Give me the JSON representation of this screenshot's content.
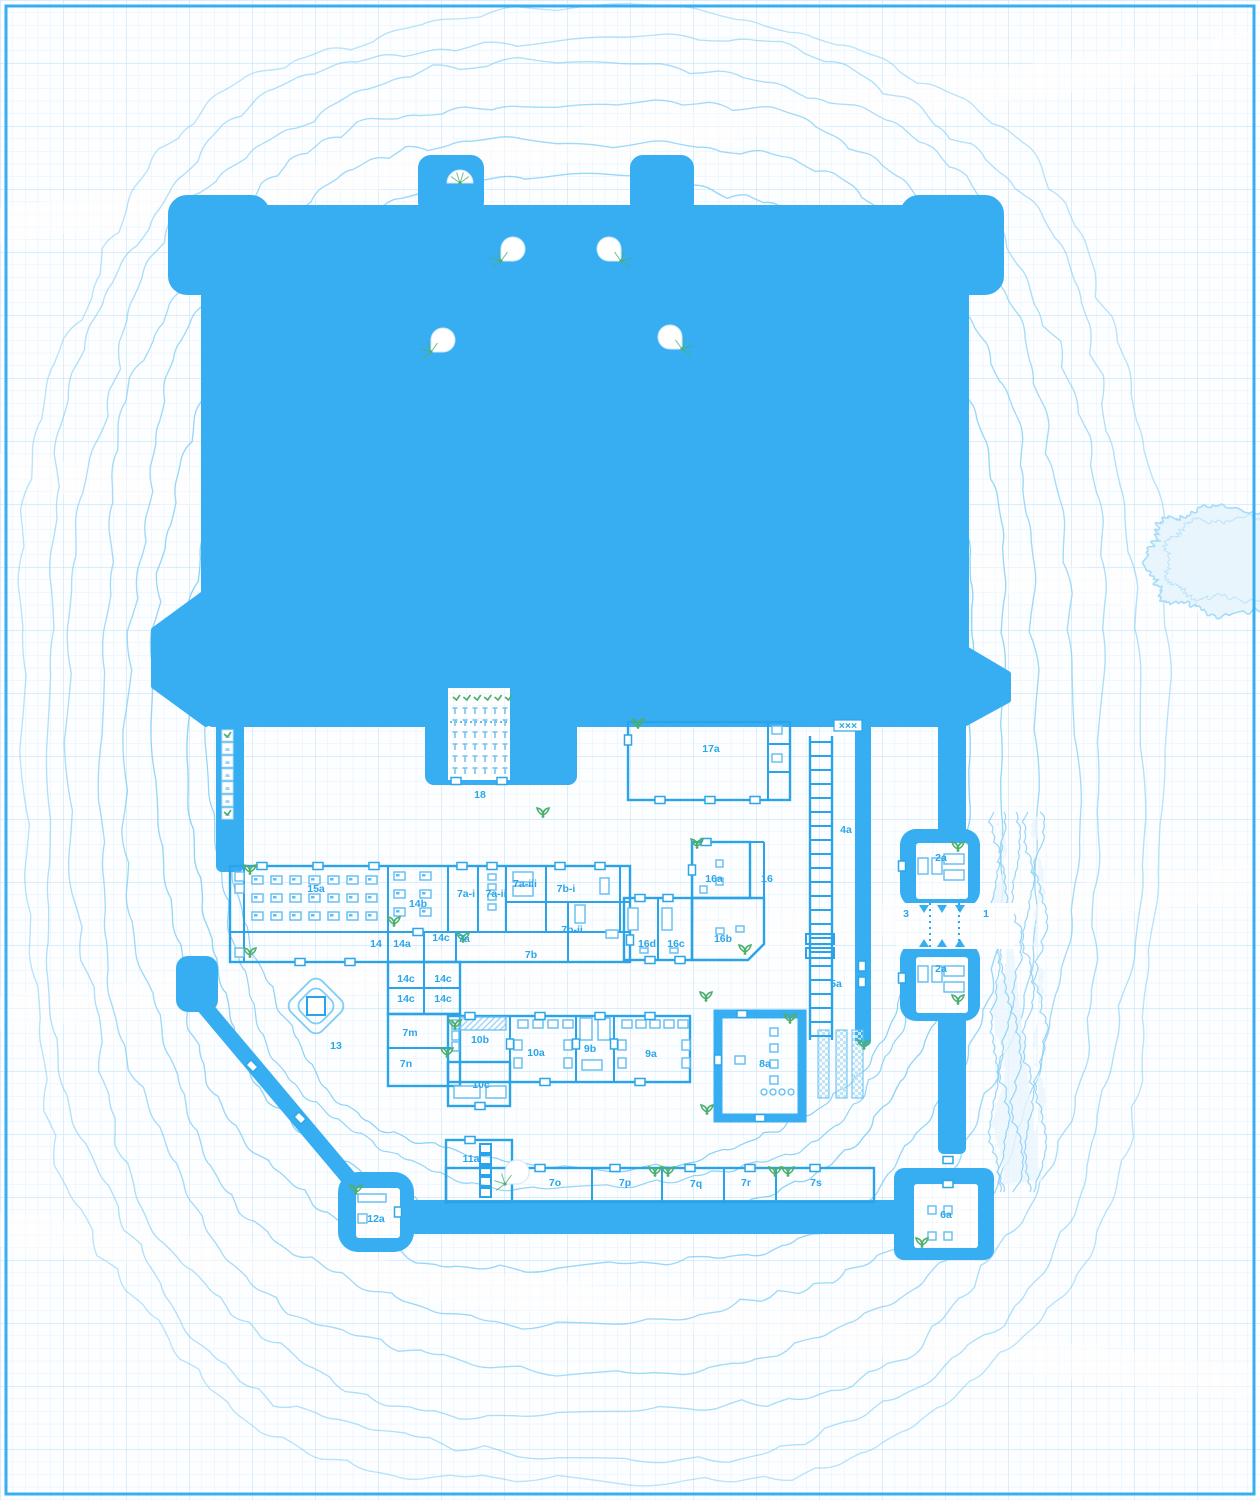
{
  "map": {
    "title": "castle-blueprint-floorplan",
    "colors": {
      "keep_blue": "#38aef2",
      "line_blue": "#2aa3e8",
      "label_blue": "#2ba6ea",
      "grid_minor": "#e2f0fb",
      "grid_major": "#cfe7f8",
      "contour": "#7fccf5",
      "water_fill": "#e9f5fd",
      "water_edge": "#a5dcf8",
      "plant_green": "#4caf6e",
      "furn_blue": "#5fbdf2",
      "paper": "#fdfeff"
    },
    "icons": [
      "plant-icon",
      "fan-stair-icon",
      "fountain-icon",
      "bed-icon",
      "door-icon",
      "ladder-stairs-icon",
      "portcullis-icon",
      "trellis-pot-icon",
      "sapling-icon",
      "spike-barrier-icon"
    ],
    "spike_barrier_text": "×××",
    "room_labels": [
      {
        "text": "15a",
        "x": 316,
        "y": 892
      },
      {
        "text": "14b",
        "x": 418,
        "y": 907
      },
      {
        "text": "7a-i",
        "x": 466,
        "y": 897
      },
      {
        "text": "7a-ii",
        "x": 496,
        "y": 897
      },
      {
        "text": "7a-iii",
        "x": 525,
        "y": 887
      },
      {
        "text": "7b-i",
        "x": 566,
        "y": 892
      },
      {
        "text": "7b-ii",
        "x": 572,
        "y": 933
      },
      {
        "text": "14",
        "x": 376,
        "y": 947
      },
      {
        "text": "14a",
        "x": 402,
        "y": 947
      },
      {
        "text": "14c",
        "x": 441,
        "y": 941
      },
      {
        "text": "7a",
        "x": 464,
        "y": 942
      },
      {
        "text": "7b",
        "x": 531,
        "y": 958
      },
      {
        "text": "14c",
        "x": 406,
        "y": 982
      },
      {
        "text": "14c",
        "x": 443,
        "y": 982
      },
      {
        "text": "14c",
        "x": 406,
        "y": 1002
      },
      {
        "text": "14c",
        "x": 443,
        "y": 1002
      },
      {
        "text": "7m",
        "x": 410,
        "y": 1036
      },
      {
        "text": "7n",
        "x": 406,
        "y": 1067
      },
      {
        "text": "17a",
        "x": 711,
        "y": 752
      },
      {
        "text": "4a",
        "x": 846,
        "y": 833
      },
      {
        "text": "5a",
        "x": 836,
        "y": 987
      },
      {
        "text": "18",
        "x": 480,
        "y": 798
      },
      {
        "text": "16",
        "x": 767,
        "y": 882
      },
      {
        "text": "16a",
        "x": 714,
        "y": 882
      },
      {
        "text": "16b",
        "x": 723,
        "y": 942
      },
      {
        "text": "16c",
        "x": 676,
        "y": 947
      },
      {
        "text": "16d",
        "x": 647,
        "y": 947
      },
      {
        "text": "13",
        "x": 336,
        "y": 1049
      },
      {
        "text": "12a",
        "x": 376,
        "y": 1222
      },
      {
        "text": "2a",
        "x": 941,
        "y": 861
      },
      {
        "text": "2a",
        "x": 941,
        "y": 972
      },
      {
        "text": "3",
        "x": 906,
        "y": 917
      },
      {
        "text": "1",
        "x": 986,
        "y": 917
      },
      {
        "text": "10b",
        "x": 480,
        "y": 1043
      },
      {
        "text": "10a",
        "x": 536,
        "y": 1056
      },
      {
        "text": "9b",
        "x": 590,
        "y": 1052
      },
      {
        "text": "9a",
        "x": 651,
        "y": 1057
      },
      {
        "text": "10c",
        "x": 481,
        "y": 1088
      },
      {
        "text": "8a",
        "x": 765,
        "y": 1067
      },
      {
        "text": "11a",
        "x": 471,
        "y": 1162
      },
      {
        "text": "7o",
        "x": 555,
        "y": 1186
      },
      {
        "text": "7p",
        "x": 625,
        "y": 1186
      },
      {
        "text": "7q",
        "x": 696,
        "y": 1187
      },
      {
        "text": "7r",
        "x": 746,
        "y": 1186
      },
      {
        "text": "7s",
        "x": 816,
        "y": 1186
      },
      {
        "text": "6a",
        "x": 946,
        "y": 1218
      }
    ],
    "features": {
      "fans": [
        {
          "x": 460,
          "y": 183,
          "kind": "half"
        },
        {
          "x": 501,
          "y": 261,
          "kind": "q270"
        },
        {
          "x": 621,
          "y": 261,
          "kind": "q180"
        },
        {
          "x": 431,
          "y": 352,
          "kind": "q270"
        },
        {
          "x": 682,
          "y": 349,
          "kind": "q180"
        },
        {
          "x": 505,
          "y": 1184,
          "kind": "q270"
        }
      ],
      "plants": [
        [
          250,
          872
        ],
        [
          250,
          955
        ],
        [
          394,
          924
        ],
        [
          463,
          940
        ],
        [
          543,
          815
        ],
        [
          697,
          846
        ],
        [
          745,
          952
        ],
        [
          706,
          999
        ],
        [
          707,
          1112
        ],
        [
          790,
          1021
        ],
        [
          455,
          1027
        ],
        [
          447,
          1055
        ],
        [
          655,
          1174
        ],
        [
          668,
          1174
        ],
        [
          775,
          1174
        ],
        [
          788,
          1174
        ],
        [
          356,
          1192
        ],
        [
          922,
          1245
        ],
        [
          958,
          849
        ],
        [
          958,
          1002
        ],
        [
          515,
          1176
        ],
        [
          864,
          1047
        ],
        [
          638,
          726
        ]
      ],
      "fountain": {
        "x": 316,
        "y": 1006
      },
      "garden": {
        "x": 448,
        "y": 688,
        "w": 62,
        "h": 92
      },
      "trellis": {
        "x": 222,
        "y": 730,
        "count": 7
      },
      "stair_4a": {
        "x1": 810,
        "x2": 832,
        "y1": 736,
        "y2": 1040
      },
      "portcullis_x": [
        930,
        959
      ],
      "spike_barrier": {
        "x": 848,
        "y": 727
      }
    }
  }
}
